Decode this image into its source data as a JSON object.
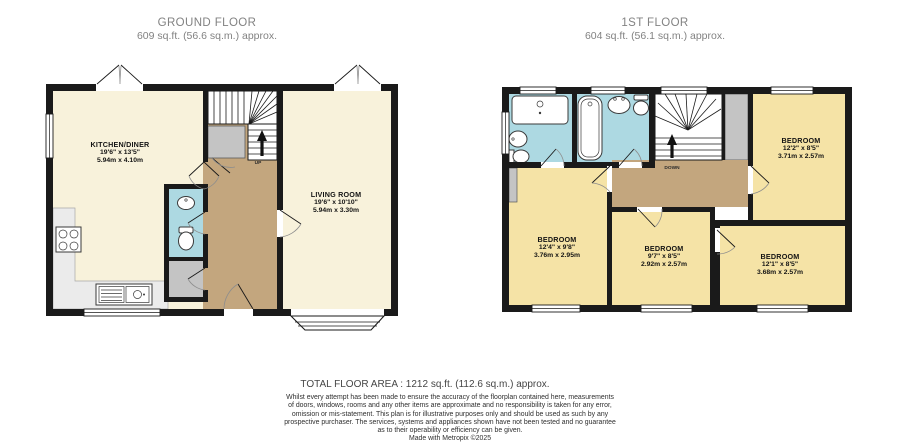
{
  "colors": {
    "wall": "#1a1a1a",
    "ground_room": "#f8f2db",
    "bedroom": "#f5e3a6",
    "hallway": "#c3a67e",
    "bathroom": "#add9e2",
    "cupboard": "#c4c4c4",
    "counter": "#ebebeb",
    "title_text": "#828282",
    "footer_text": "#2f2f2f"
  },
  "floors": {
    "ground": {
      "title": "GROUND FLOOR",
      "subtitle": "609 sq.ft. (56.6 sq.m.) approx.",
      "stair_label": "UP",
      "rooms": [
        {
          "name": "KITCHEN/DINER",
          "dims_ft": "19'6\" x 13'5\"",
          "dims_m": "5.94m x 4.10m"
        },
        {
          "name": "LIVING ROOM",
          "dims_ft": "19'6\" x 10'10\"",
          "dims_m": "5.94m x 3.30m"
        }
      ]
    },
    "first": {
      "title": "1ST FLOOR",
      "subtitle": "604 sq.ft. (56.1 sq.m.) approx.",
      "stair_label": "DOWN",
      "rooms": [
        {
          "name": "BEDROOM",
          "dims_ft": "12'2\" x 8'5\"",
          "dims_m": "3.71m x 2.57m"
        },
        {
          "name": "BEDROOM",
          "dims_ft": "12'4\" x 9'8\"",
          "dims_m": "3.76m x 2.95m"
        },
        {
          "name": "BEDROOM",
          "dims_ft": "9'7\" x 8'5\"",
          "dims_m": "2.92m x 2.57m"
        },
        {
          "name": "BEDROOM",
          "dims_ft": "12'1\" x 8'5\"",
          "dims_m": "3.68m x 2.57m"
        }
      ]
    }
  },
  "footer": {
    "total_area": "TOTAL FLOOR AREA : 1212 sq.ft. (112.6 sq.m.) approx.",
    "disclaimer_lines": [
      "Whilst every attempt has been made to ensure the accuracy of the floorplan contained here, measurements",
      "of doors, windows, rooms and any other items are approximate and no responsibility is taken for any error,",
      "omission or mis-statement. This plan is for illustrative purposes only and should be used as such by any",
      "prospective purchaser. The services, systems and appliances shown have not been tested and no guarantee",
      "as to their operability or efficiency can be given."
    ],
    "credit": "Made with Metropix ©2025"
  }
}
